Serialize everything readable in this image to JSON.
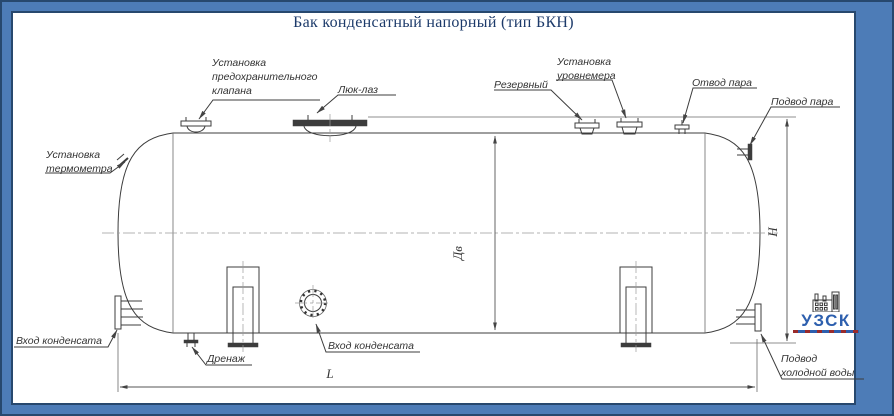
{
  "title": "Бак конденсатный напорный (тип БКН)",
  "labels": {
    "safety_valve": {
      "lines": [
        "Установка",
        "предохранительного",
        "клапана"
      ]
    },
    "manhole": "Люк-лаз",
    "reserve": "Резервный",
    "level_gauge": {
      "lines": [
        "Установка",
        "уровнемера"
      ]
    },
    "steam_outlet": "Отвод пара",
    "steam_inlet": "Подвод пара",
    "thermometer": {
      "lines": [
        "Установка",
        "термометра"
      ]
    },
    "condensate_inlet_left": "Вход конденсата",
    "drain": "Дренаж",
    "condensate_inlet_front": "Вход конденсата",
    "cold_water": {
      "lines": [
        "Подвод",
        "холодной воды"
      ]
    }
  },
  "dimensions": {
    "diameter": "Дв",
    "height": "H",
    "length": "L"
  },
  "logo": {
    "text": "УЗСК"
  },
  "colors": {
    "frame_blue": "#4d7cb7",
    "frame_line": "#27486e",
    "title_text": "#1c3a6a",
    "logo_blue": "#2d5fae",
    "drawing_line": "#3c3c3c"
  }
}
